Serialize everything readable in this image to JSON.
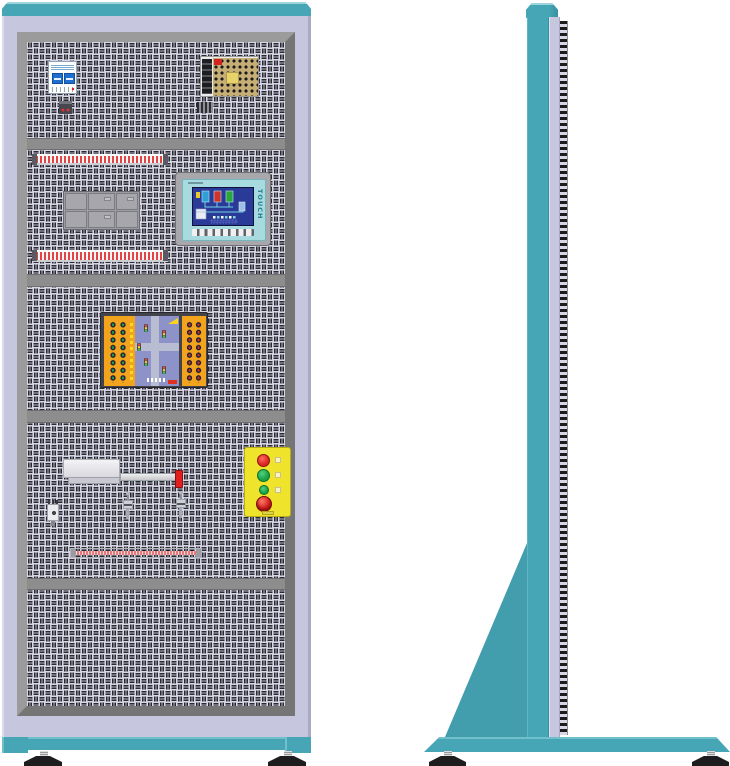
{
  "hmi": {
    "touch_label": "TOUCH",
    "function_key_count": 8,
    "screen_elements": [
      "tank-blue",
      "tank-red",
      "tank-green",
      "pipes",
      "iso-box",
      "indicator-row"
    ]
  },
  "front_view": {
    "sections": [
      {
        "name": "breaker-and-power-supply",
        "components": [
          "circuit-breaker-icon",
          "power-supply-icon",
          "terminal-connector-icon",
          "terminal-connector-icon"
        ]
      },
      {
        "name": "control-and-hmi",
        "components": [
          "terminal-strip-icon",
          "relay-module-block-icon",
          "hmi-touch-panel-icon",
          "terminal-strip-icon"
        ]
      },
      {
        "name": "traffic-light-training-board",
        "components": [
          "banana-jack-panel-green",
          "intersection-diagram",
          "banana-jack-panel-red"
        ]
      },
      {
        "name": "actuator-and-pushbuttons",
        "components": [
          "pneumatic-actuator-icon",
          "red-lever-icon",
          "sensor-valve-icon",
          "sensor-valve-icon",
          "relay-icon",
          "pushbutton-station-icon",
          "terminal-strip-icon"
        ]
      },
      {
        "name": "empty-panel",
        "components": []
      }
    ],
    "pushbuttons": [
      "red-button",
      "green-button",
      "small-green-button",
      "emergency-stop-mushroom"
    ],
    "feet_count": 2
  },
  "side_view": {
    "components": [
      "top-cap",
      "upright-column",
      "perforated-edge-strip",
      "triangular-gusset",
      "base-plate",
      "leveling-foot",
      "leveling-foot"
    ]
  },
  "colors": {
    "teal": "#46a6b6",
    "teal-light": "#9ed4dc",
    "teal-dark": "#37909f",
    "lavender": "#c6c6de",
    "lavender-dark": "#a9a9c6",
    "lavender-light": "#dcdcea",
    "frame": "#8c8c8c",
    "frame-light": "#9b9b9b",
    "frame-dark": "#757575",
    "weave-bg": "#d7d7e7",
    "weave-bar": "#28282f",
    "divider": "#8d8d8d",
    "hmi-frame": "#a8a8ac",
    "hmi-bezel": "#a7dbe0",
    "hmi-screen": "#2a3a99",
    "hmi-text": "#257f8e",
    "board-orange": "#f3a41f",
    "board-frame": "#43434b",
    "board-blue": "#8d93c9",
    "dot-green": "#1ca14b",
    "dot-red": "#cf2f22",
    "btn-yellow": "#efe32b",
    "btn-red": "#dc2626",
    "btn-green": "#18a347",
    "estop-red": "#d01f1f",
    "strip-red": "#e04444",
    "strip-pink": "#e87878",
    "psu-board": "#c6ae74",
    "foot-black": "#1d1d1f"
  }
}
